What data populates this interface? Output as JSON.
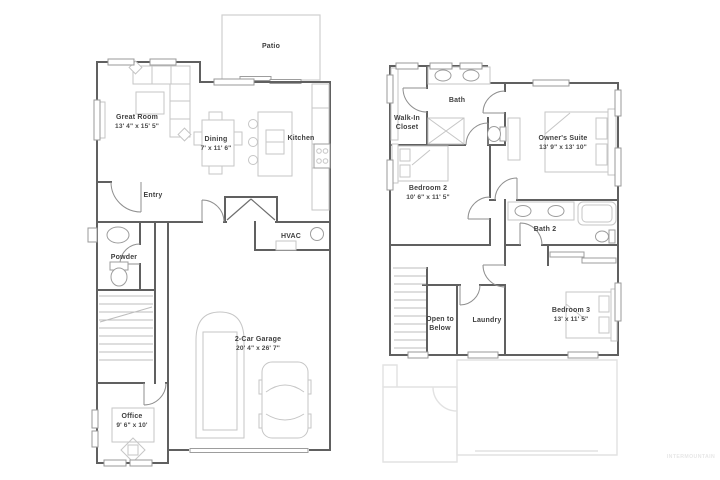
{
  "watermark": "INTERMOUNTAIN",
  "colors": {
    "wall": "#606060",
    "furniture": "#c6c6c6",
    "ghost_outline": "#e2e2e2",
    "label_text": "#3f3f3f",
    "background": "#ffffff"
  },
  "floor1": {
    "patio": {
      "label": "Patio"
    },
    "great_room": {
      "label": "Great Room",
      "dims": "13' 4\" x 15' 5\""
    },
    "dining": {
      "label": "Dining",
      "dims": "7' x 11' 6\""
    },
    "kitchen": {
      "label": "Kitchen"
    },
    "entry": {
      "label": "Entry"
    },
    "hvac": {
      "label": "HVAC"
    },
    "powder": {
      "label": "Powder"
    },
    "garage": {
      "label": "2-Car Garage",
      "dims": "20' 4\" x 26' 7\""
    },
    "office": {
      "label": "Office",
      "dims": "9' 6\" x 10'"
    }
  },
  "floor2": {
    "bath": {
      "label": "Bath"
    },
    "walk_in_closet": {
      "line1": "Walk-In",
      "line2": "Closet"
    },
    "owners_suite": {
      "label": "Owner's Suite",
      "dims": "13' 9\" x 13' 10\""
    },
    "bedroom2": {
      "label": "Bedroom 2",
      "dims": "10' 6\" x 11' 5\""
    },
    "bath2": {
      "label": "Bath 2"
    },
    "open_to_below": {
      "line1": "Open to",
      "line2": "Below"
    },
    "laundry": {
      "label": "Laundry"
    },
    "bedroom3": {
      "label": "Bedroom 3",
      "dims": "13' x 11' 5\""
    }
  }
}
